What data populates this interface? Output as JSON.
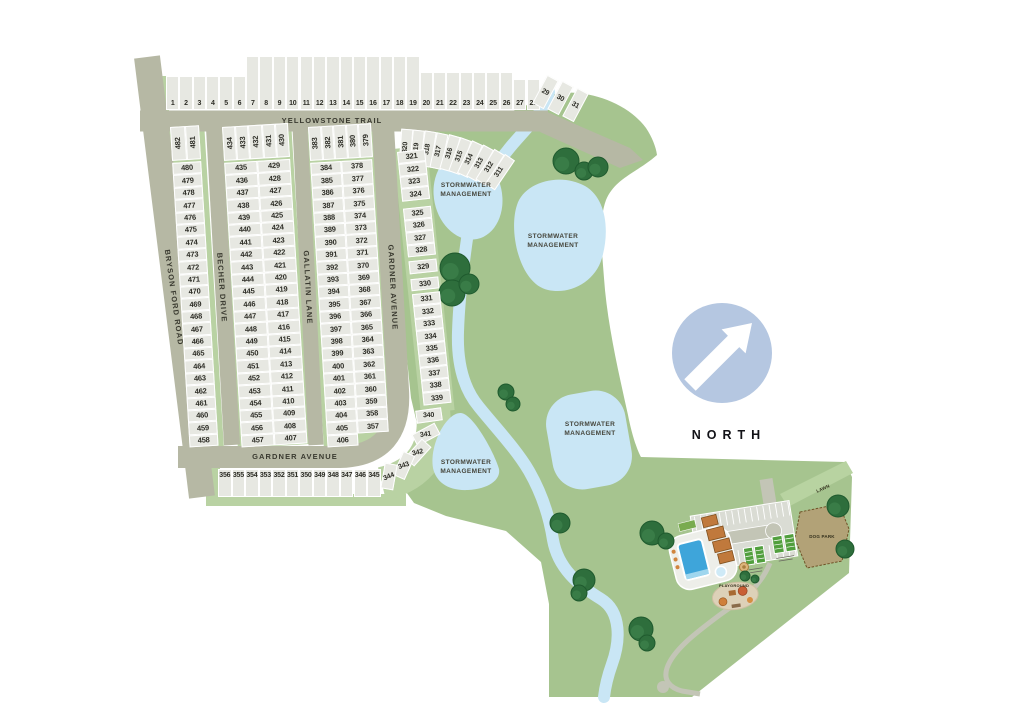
{
  "map": {
    "streets": {
      "yellowstone_trail": "YELLOWSTONE TRAIL",
      "bryson_ford_road": "BRYSON FORD ROAD",
      "becher_drive": "BECHER DRIVE",
      "gallatin_lane": "GALLATIN LANE",
      "gardner_avenue_vertical": "GARDNER AVENUE",
      "gardner_avenue_horizontal": "GARDNER AVENUE"
    },
    "labels": {
      "stormwater": "STORMWATER\nMANAGEMENT",
      "north": "NORTH",
      "lawn": "LAWN",
      "dog_park": "DOG PARK",
      "playground": "PLAYGROUND"
    },
    "colors": {
      "green": "#a6c48f",
      "green_light": "#b9d2a3",
      "road": "#b6b8a4",
      "lot_fill": "#e7e8e2",
      "water": "#c9e6f5",
      "tree": "#2e6e3c",
      "north_circle": "#b5c7e1",
      "pool": "#3ea5da",
      "building": "#c0793c",
      "dog_park_fill": "#b2a277",
      "parking": "#dadcd4"
    },
    "lots": {
      "top_row": [
        1,
        2,
        3,
        4,
        5,
        6,
        7,
        8,
        9,
        10,
        11,
        12,
        13,
        14,
        15,
        16,
        17,
        18,
        19,
        20,
        21,
        22,
        23,
        24,
        25,
        26,
        27,
        28
      ],
      "top_row_angled": [
        29,
        30,
        31
      ],
      "west_col_top": [
        482,
        481
      ],
      "west_col": [
        480,
        479,
        478,
        477,
        476,
        475,
        474,
        473,
        472,
        471,
        470,
        469,
        468,
        467,
        466,
        465,
        464,
        463,
        462,
        461,
        460,
        459,
        458
      ],
      "becher_top": [
        434,
        433,
        432,
        431,
        430
      ],
      "becher_left": [
        435,
        436,
        437,
        438,
        439,
        440,
        441,
        442,
        443,
        444,
        445,
        446,
        447,
        448,
        449,
        450,
        451,
        452,
        453,
        454,
        455,
        456,
        457
      ],
      "becher_right": [
        429,
        428,
        427,
        426,
        425,
        424,
        423,
        422,
        421,
        420,
        419,
        418,
        417,
        416,
        415,
        414,
        413,
        412,
        411,
        410,
        409,
        408,
        407
      ],
      "gallatin_top": [
        383,
        382,
        381,
        380,
        379
      ],
      "gallatin_left": [
        384,
        385,
        386,
        387,
        388,
        389,
        390,
        391,
        392,
        393,
        394,
        395,
        396,
        397,
        398,
        399,
        400,
        401,
        402,
        403,
        404,
        405,
        406
      ],
      "gallatin_right": [
        378,
        377,
        376,
        375,
        374,
        373,
        372,
        371,
        370,
        369,
        368,
        367,
        366,
        365,
        364,
        363,
        362,
        361,
        360,
        359,
        358,
        357
      ],
      "east_top_angled": [
        320,
        319,
        318,
        317,
        316,
        315,
        314,
        313,
        312,
        311
      ],
      "east_col": [
        321,
        322,
        323,
        324,
        325,
        326,
        327,
        328,
        329,
        330,
        331,
        332,
        333,
        334,
        335,
        336,
        337,
        338,
        339
      ],
      "curve": [
        340,
        341,
        342,
        343,
        344
      ],
      "bottom_row": [
        356,
        355,
        354,
        353,
        352,
        351,
        350,
        349,
        348,
        347,
        346,
        345
      ]
    }
  }
}
